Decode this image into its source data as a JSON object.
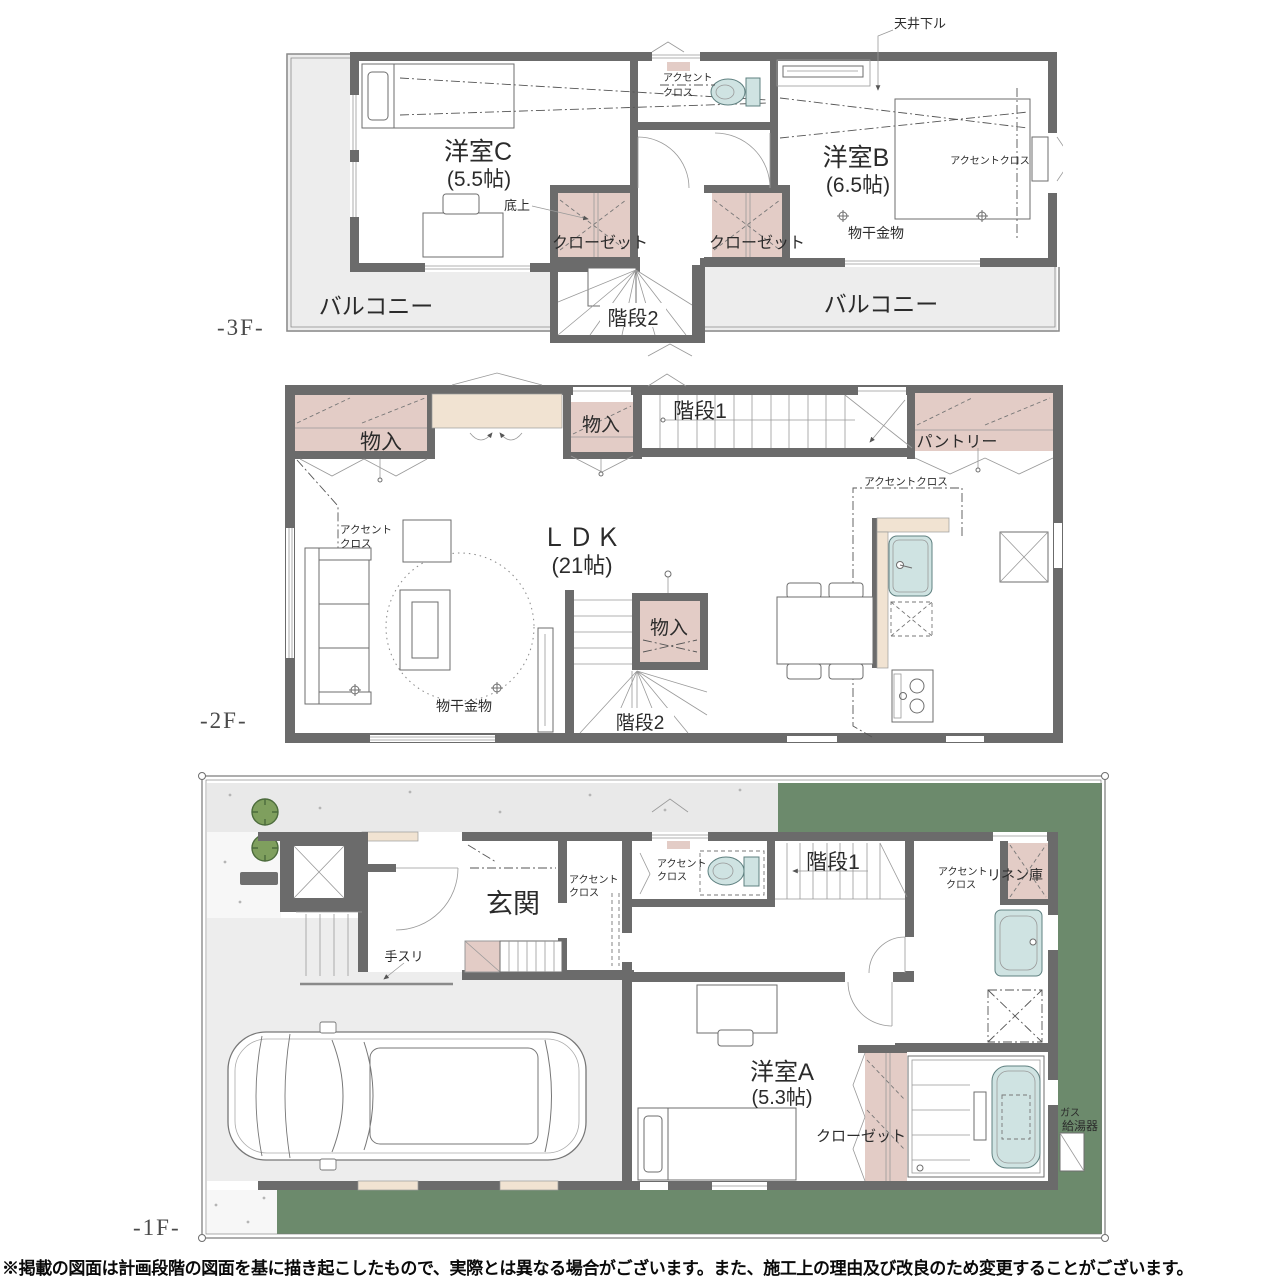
{
  "colors": {
    "wall": "#6b6b6b",
    "closet_pink": "#e3ccc6",
    "counter_beige": "#f1e3d2",
    "fixture_blue": "#cfe3e2",
    "lawn_green": "#6c8a6c",
    "paving_gray": "#ededed",
    "tree_green": "#7f9f5e"
  },
  "floor_labels": {
    "f3": "-3F-",
    "f2": "-2F-",
    "f1": "-1F-"
  },
  "labels": {
    "balcony": "バルコニー",
    "closet": "クローゼット",
    "storage": "物入",
    "stairs1": "階段1",
    "stairs2": "階段2",
    "pantry": "パントリー",
    "accent_line1": "アクセント",
    "accent_line2": "クロス",
    "accent_cloth": "アクセントクロス",
    "monohoshi": "物干金物",
    "ceiling_drop": "天井下ル",
    "floor_raised": "底上",
    "genkan": "玄関",
    "handrail": "手スリ",
    "linen": "リネン庫",
    "gas": "ガス",
    "water_heater": "給湯器"
  },
  "rooms": {
    "room_c_name": "洋室C",
    "room_c_size": "(5.5帖)",
    "room_b_name": "洋室B",
    "room_b_size": "(6.5帖)",
    "room_a_name": "洋室A",
    "room_a_size": "(5.3帖)",
    "ldk_name": "ＬＤＫ",
    "ldk_size": "(21帖)"
  },
  "disclaimer": "※掲載の図面は計画段階の図面を基に描き起こしたもので、実際とは異なる場合がございます。また、施工上の理由及び改良のため変更することがございます。"
}
